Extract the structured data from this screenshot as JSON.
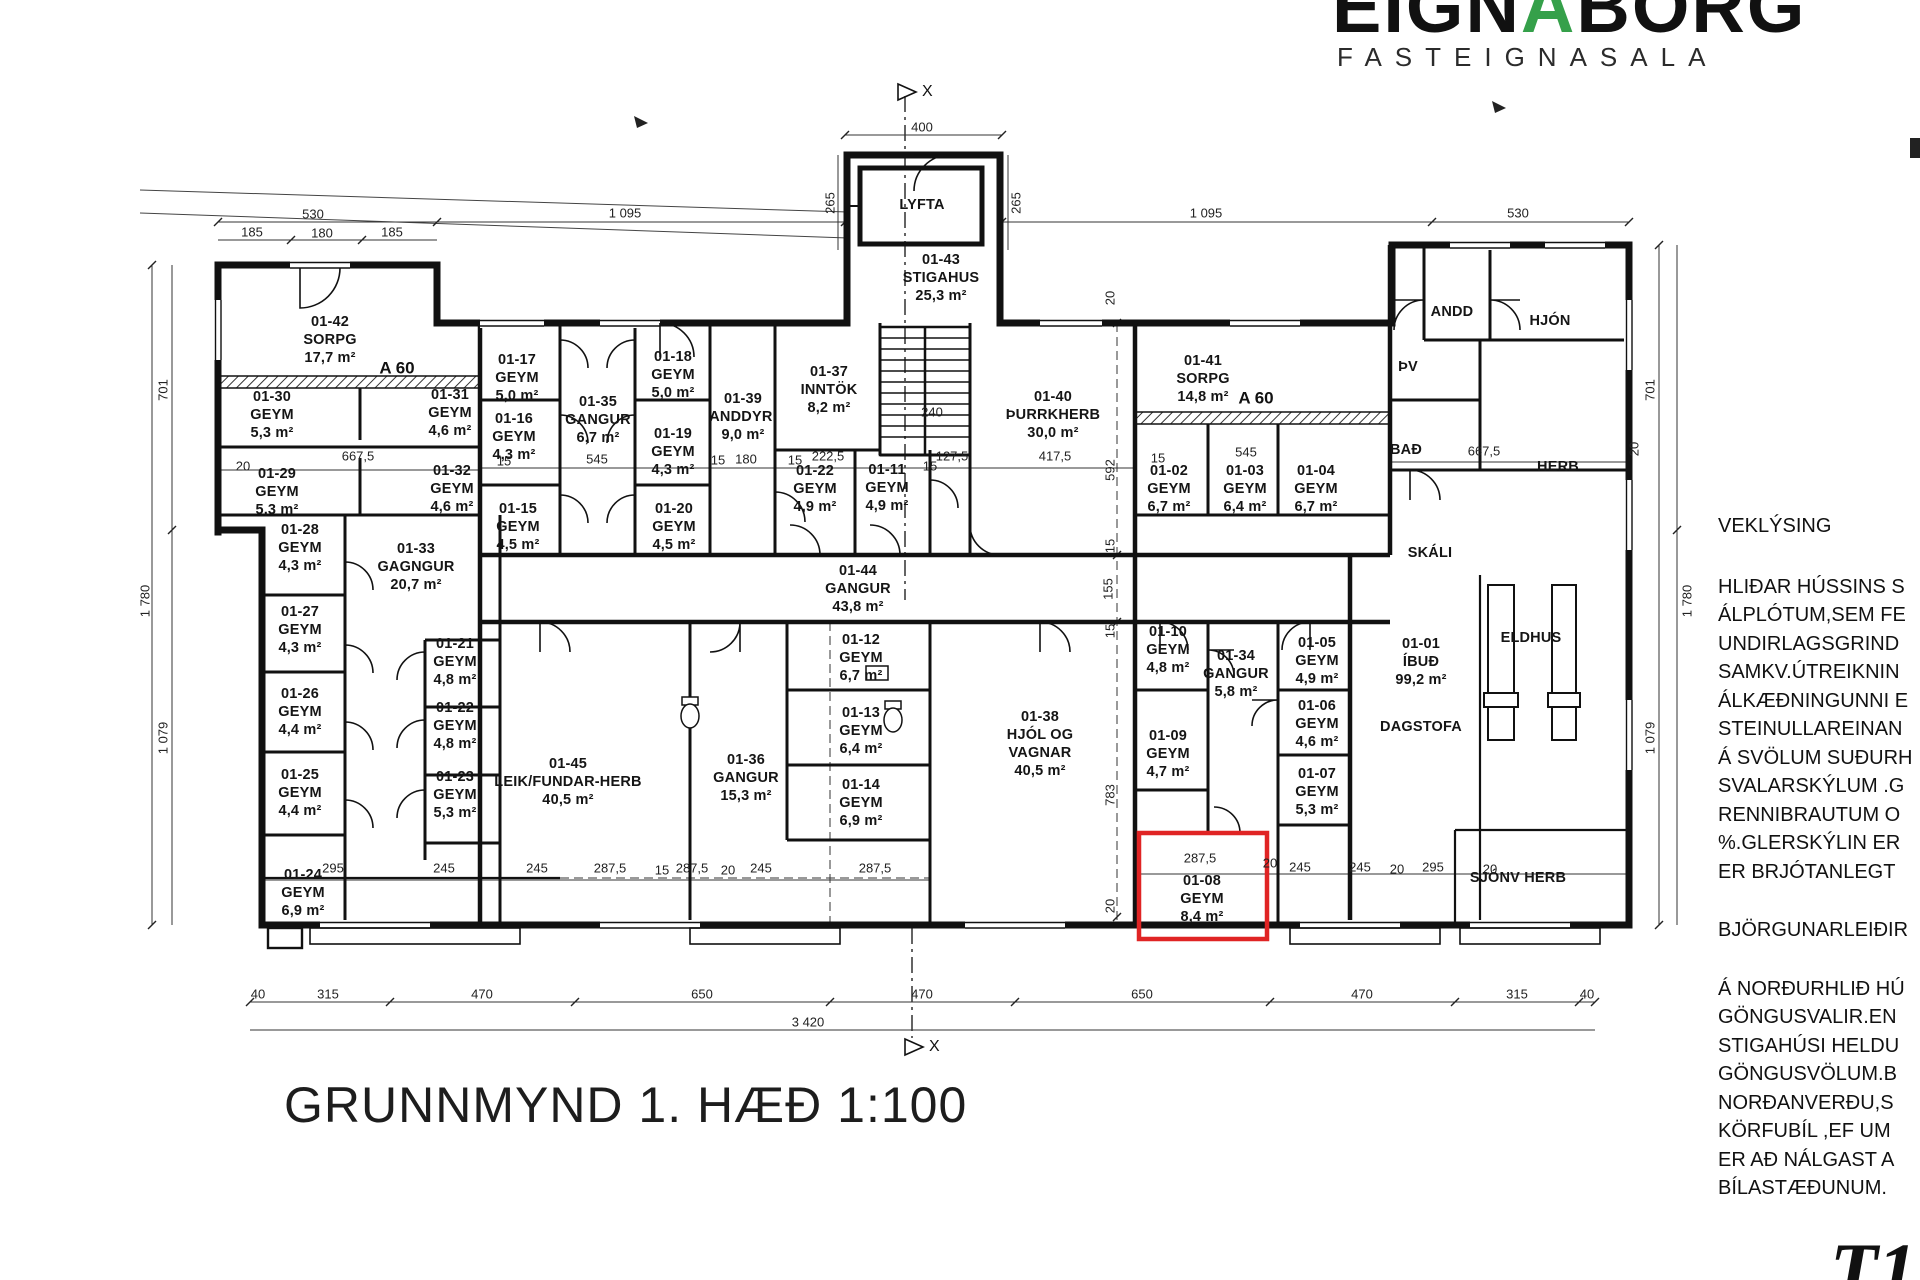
{
  "logo": {
    "name_pre": "EIGN",
    "name_accent": "A",
    "name_post": "BORG",
    "subtitle": "FASTEIGNASALA"
  },
  "title": "GRUNNMYND 1. HÆÐ  1:100",
  "section_marker_letter": "X",
  "watermark": "T1",
  "colors": {
    "accent_green": "#35a04a",
    "highlight_red": "#e02424",
    "line_black": "#1a1a1a"
  },
  "zone_labels": {
    "a60": "A 60"
  },
  "notes": {
    "heading1": "VEKLÝSING",
    "para1": [
      "HLIÐAR HÚSSINS S",
      "ÁLPLÓTUM,SEM FE",
      "UNDIRLAGSGRIND",
      "SAMKV.ÚTREIKNIN",
      "ÁLKÆÐNINGUNNI E",
      "STEINULLAREINAN",
      "Á SVÖLUM SUÐURH",
      "SVALARSKÝLUM .G",
      "RENNIBRAUTUM O",
      "%.GLERSKÝLIN ER",
      "ER BRJÓTANLEGT"
    ],
    "heading2": "BJÖRGUNARLEIÐIR",
    "para2": [
      "Á NORÐURHLIÐ HÚ",
      "GÖNGUSVALIR.EN",
      "STIGAHÚSI HELDU",
      "GÖNGUSVÖLUM.B",
      "NORÐANVERÐU,S",
      "KÖRFUBÍL ,EF UM",
      "ER AÐ NÁLGAST A",
      "BÍLASTÆÐUNUM."
    ]
  },
  "rooms": {
    "r01_42": {
      "id": "01-42",
      "name": "SORPG",
      "area": "17,7 m²"
    },
    "r01_30": {
      "id": "01-30",
      "name": "GEYM",
      "area": "5,3 m²"
    },
    "r01_31": {
      "id": "01-31",
      "name": "GEYM",
      "area": "4,6 m²"
    },
    "r01_29": {
      "id": "01-29",
      "name": "GEYM",
      "area": "5,3 m²"
    },
    "r01_32": {
      "id": "01-32",
      "name": "GEYM",
      "area": "4,6 m²"
    },
    "r01_28": {
      "id": "01-28",
      "name": "GEYM",
      "area": "4,3 m²"
    },
    "r01_33": {
      "id": "01-33",
      "name": "GAGNGUR",
      "area": "20,7 m²"
    },
    "r01_27": {
      "id": "01-27",
      "name": "GEYM",
      "area": "4,3 m²"
    },
    "r01_26": {
      "id": "01-26",
      "name": "GEYM",
      "area": "4,4 m²"
    },
    "r01_25": {
      "id": "01-25",
      "name": "GEYM",
      "area": "4,4 m²"
    },
    "r01_24": {
      "id": "01-24",
      "name": "GEYM",
      "area": "6,9 m²"
    },
    "r01_21": {
      "id": "01-21",
      "name": "GEYM",
      "area": "4,8 m²"
    },
    "r01_22l": {
      "id": "01-22",
      "name": "GEYM",
      "area": "4,8 m²"
    },
    "r01_23": {
      "id": "01-23",
      "name": "GEYM",
      "area": "5,3 m²"
    },
    "r01_17": {
      "id": "01-17",
      "name": "GEYM",
      "area": "5,0 m²"
    },
    "r01_16": {
      "id": "01-16",
      "name": "GEYM",
      "area": "4,3 m²"
    },
    "r01_15": {
      "id": "01-15",
      "name": "GEYM",
      "area": "4,5 m²"
    },
    "r01_35": {
      "id": "01-35",
      "name": "GANGUR",
      "area": "6,7 m²"
    },
    "r01_18": {
      "id": "01-18",
      "name": "GEYM",
      "area": "5,0 m²"
    },
    "r01_19": {
      "id": "01-19",
      "name": "GEYM",
      "area": "4,3 m²"
    },
    "r01_20": {
      "id": "01-20",
      "name": "GEYM",
      "area": "4,5 m²"
    },
    "r01_39": {
      "id": "01-39",
      "name": "ANDDYRI",
      "area": "9,0 m²"
    },
    "r01_37": {
      "id": "01-37",
      "name": "INNTÖK",
      "area": "8,2 m²"
    },
    "r01_43": {
      "id": "01-43",
      "name": "STIGAHUS",
      "area": "25,3 m²"
    },
    "lyfta": {
      "name": "LYFTA"
    },
    "r01_40": {
      "id": "01-40",
      "name": "ÞURRKHERB",
      "area": "30,0 m²"
    },
    "r01_41": {
      "id": "01-41",
      "name": "SORPG",
      "area": "14,8 m²"
    },
    "r01_02": {
      "id": "01-02",
      "name": "GEYM",
      "area": "6,7 m²"
    },
    "r01_03": {
      "id": "01-03",
      "name": "GEYM",
      "area": "6,4 m²"
    },
    "r01_04": {
      "id": "01-04",
      "name": "GEYM",
      "area": "6,7 m²"
    },
    "r01_44": {
      "id": "01-44",
      "name": "GANGUR",
      "area": "43,8 m²"
    },
    "r01_22c": {
      "id": "01-22",
      "name": "GEYM",
      "area": "4,9 m²"
    },
    "r01_11": {
      "id": "01-11",
      "name": "GEYM",
      "area": "4,9 m²"
    },
    "r01_45": {
      "id": "01-45",
      "name": "LEIK/FUNDAR-HERB",
      "area": "40,5 m²"
    },
    "r01_36": {
      "id": "01-36",
      "name": "GANGUR",
      "area": "15,3 m²"
    },
    "r01_12": {
      "id": "01-12",
      "name": "GEYM",
      "area": "6,7 m²"
    },
    "r01_13": {
      "id": "01-13",
      "name": "GEYM",
      "area": "6,4 m²"
    },
    "r01_14": {
      "id": "01-14",
      "name": "GEYM",
      "area": "6,9 m²"
    },
    "r01_38": {
      "id": "01-38",
      "name": "HJÓL OG VAGNAR",
      "area": "40,5 m²"
    },
    "r01_10": {
      "id": "01-10",
      "name": "GEYM",
      "area": "4,8 m²"
    },
    "r01_34": {
      "id": "01-34",
      "name": "GANGUR",
      "area": "5,8 m²"
    },
    "r01_09": {
      "id": "01-09",
      "name": "GEYM",
      "area": "4,7 m²"
    },
    "r01_05": {
      "id": "01-05",
      "name": "GEYM",
      "area": "4,9 m²"
    },
    "r01_06": {
      "id": "01-06",
      "name": "GEYM",
      "area": "4,6 m²"
    },
    "r01_07": {
      "id": "01-07",
      "name": "GEYM",
      "area": "5,3 m²"
    },
    "r01_08": {
      "id": "01-08",
      "name": "GEYM",
      "area": "8,4 m²"
    },
    "r01_01": {
      "id": "01-01",
      "name": "ÍBUÐ",
      "area": "99,2 m²"
    },
    "andd": {
      "name": "ANDD"
    },
    "hjon": {
      "name": "HJÓN"
    },
    "thv": {
      "name": "ÞV"
    },
    "bad": {
      "name": "BAÐ"
    },
    "herb": {
      "name": "HERB"
    },
    "skali": {
      "name": "SKÁLI"
    },
    "eldhus": {
      "name": "ELDHUS"
    },
    "dagstofa": {
      "name": "DAGSTOFA"
    },
    "sjonv": {
      "name": "SJÓNV HERB"
    }
  },
  "dims": {
    "15": "15",
    "20": "20",
    "40": "40",
    "155": "155",
    "180": "180",
    "185": "185",
    "222_5": "222,5",
    "240": "240",
    "245": "245",
    "265": "265",
    "287_5": "287,5",
    "295": "295",
    "315": "315",
    "400": "400",
    "417_5": "417,5",
    "470": "470",
    "530": "530",
    "545": "545",
    "592": "592",
    "650": "650",
    "667_5": "667,5",
    "701": "701",
    "783": "783",
    "1079": "1 079",
    "1095": "1 095",
    "1780": "1 780",
    "3420": "3 420",
    "127_5": "127,5"
  }
}
